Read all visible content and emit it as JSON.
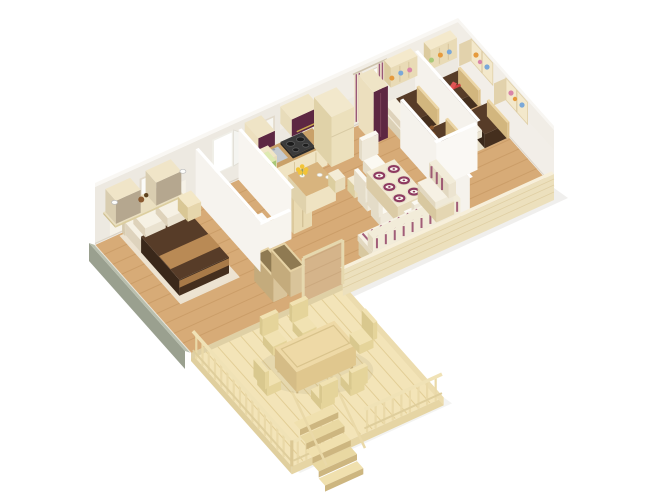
{
  "scene": {
    "description": "3D isometric cutaway floor plan render of a three-bedroom holiday mobile home with kitchen, dining-living area, bathroom and a large wooden deck with outdoor dining set and stairs",
    "projection": "isometric-cutaway",
    "background": "#ffffff"
  },
  "palette": {
    "wall": "#ede9e1",
    "wallBright": "#f1ede6",
    "wallTop": "#f9f7f3",
    "floor": "#d7ab77",
    "floorLine": "#c2935d",
    "deck": "#f3e4b8",
    "deckLine": "#e0cb92",
    "rail": "#ead9a8",
    "cream": "#efe3c2",
    "creamWall": "#ece0bd",
    "wood": "#c9a169",
    "brown": "#573c28",
    "brownDark": "#452f1e",
    "tan": "#b98a55",
    "white": "#f6f1e4",
    "purple": "#5d2742",
    "accentPurple": "#8e3a60",
    "grayGreen": "#9aa08f",
    "yellow": "#f2c437",
    "red": "#d24040",
    "green": "#a8c878",
    "blue": "#7aa8d8",
    "orange": "#e59a3c",
    "pink": "#d884a8"
  },
  "rooms": [
    {
      "id": "master-bedroom",
      "furniture": [
        "double-bed",
        "white-pillows",
        "brown-bedspread",
        "tan-bed-runner",
        "headboard",
        "wall-cabinets",
        "wall-shelf",
        "bedside-table",
        "wall-lamps",
        "decor-items"
      ]
    },
    {
      "id": "bathroom",
      "furniture": [
        "shower-tray",
        "white-partition-walls",
        "bright-window"
      ]
    },
    {
      "id": "storage",
      "furniture": [
        "open-storage-boxes",
        "hall-cabinet"
      ]
    },
    {
      "id": "kitchen",
      "furniture": [
        "tall-purple-cabinet",
        "counter",
        "four-burner-stove",
        "sink",
        "purple-wall-cabinet",
        "fridge-column",
        "corner-shelf",
        "green-boxes",
        "red-boxes",
        "island-counter",
        "yellow-flowers",
        "cups",
        "bar-stools"
      ]
    },
    {
      "id": "dining-area",
      "furniture": [
        "dining-table",
        "purple-plates",
        "white-chairs"
      ]
    },
    {
      "id": "living-area",
      "furniture": [
        "bench-sofa",
        "purple-striped-cushions"
      ]
    },
    {
      "id": "hallway",
      "furniture": [
        "purple-wardrobe"
      ]
    },
    {
      "id": "kids-bedroom-1",
      "furniture": [
        "single-bed",
        "single-bed",
        "nightstand",
        "yellow-lamp",
        "teddy-bear",
        "wall-shelf-cubbies",
        "toys",
        "striped-curtain-window"
      ]
    },
    {
      "id": "kids-bedroom-2",
      "furniture": [
        "single-bed",
        "single-bed",
        "nightstand",
        "yellow-lamp",
        "red-toy-plane",
        "wall-shelf-cubbies",
        "toys"
      ]
    },
    {
      "id": "deck",
      "furniture": [
        "outdoor-dining-table",
        "outdoor-chairs",
        "wood-railing",
        "stairs"
      ]
    }
  ],
  "counts": {
    "double_beds": 1,
    "single_beds": 4,
    "dining_plates": 6,
    "dining_chairs": 4,
    "outdoor_chairs": 6,
    "deck_stair_steps": 5,
    "windows": 4
  }
}
